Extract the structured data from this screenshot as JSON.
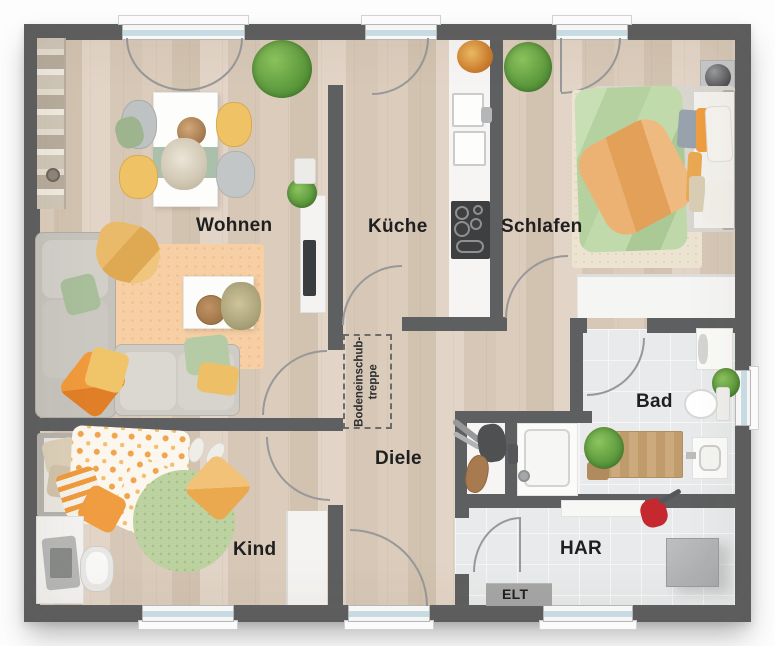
{
  "floorplan": {
    "title": "Wohnung Grundriss",
    "room_labels": {
      "living": "Wohnen",
      "kitchen": "Küche",
      "bedroom": "Schlafen",
      "bathroom": "Bad",
      "hallway": "Diele",
      "child_room": "Kind",
      "utility_room": "HAR",
      "electrical_cabinet": "ELT",
      "attic_ladder_line1": "Bodeneinschub-",
      "attic_ladder_line2": "treppe"
    },
    "colors": {
      "wall": "#5e5f60",
      "wood_floor": "#d8c9b9",
      "tile_floor": "#e8eaeb",
      "window_glass": "#cde2ec",
      "accent_yellow": "#efc266",
      "accent_orange": "#ef9d40",
      "accent_green": "#aabf9c",
      "rug_peach": "#f7cfa4",
      "label_text": "#1f1f1f"
    }
  }
}
